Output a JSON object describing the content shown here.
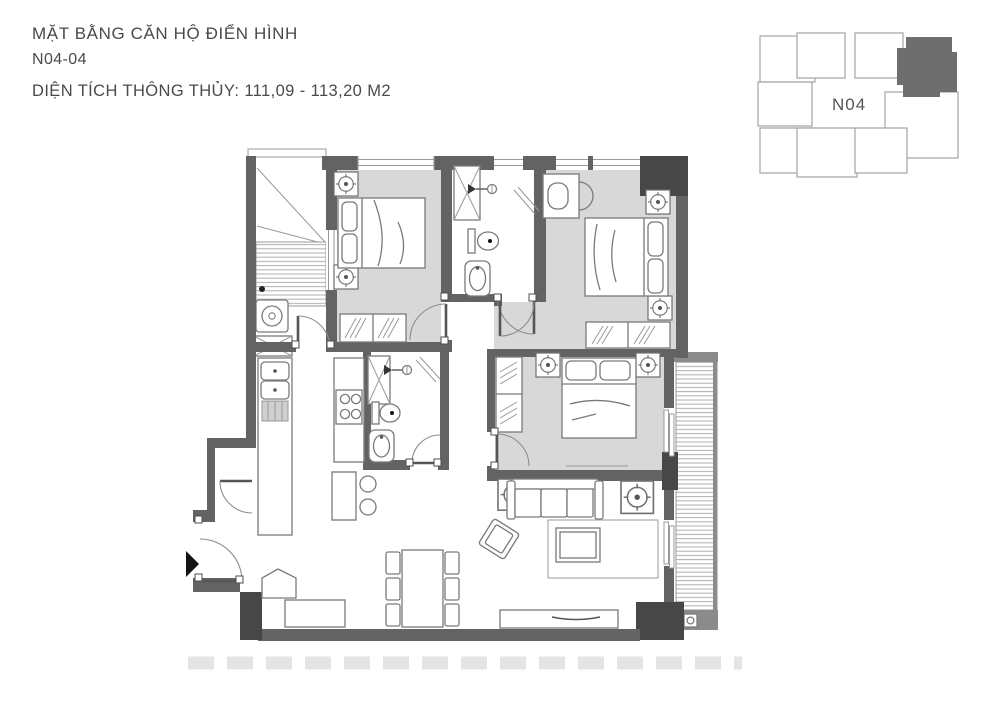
{
  "title": {
    "line1": "MẶT BẰNG CĂN HỘ ĐIỂN HÌNH",
    "line2": "N04-04",
    "line3": "DIỆN TÍCH THÔNG THỦY: 111,09 - 113,20 M2"
  },
  "keyplan": {
    "label": "N04",
    "highlighted_unit": "top-right"
  },
  "colors": {
    "wall": "#636363",
    "wall_dark": "#474747",
    "room_fill": "#d8d8d8",
    "outline": "#7a7a7a",
    "stripe": "#b5b5b5",
    "keyplan_highlight": "#6e6e6e",
    "background": "#ffffff"
  },
  "icons": {
    "entrance_arrow": "right-pointing-triangle"
  }
}
